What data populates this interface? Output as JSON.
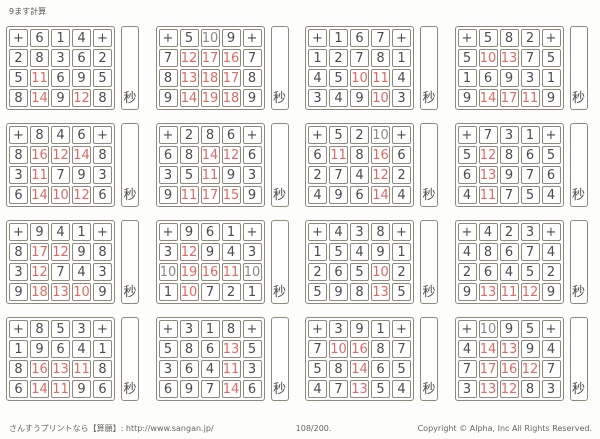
{
  "page": {
    "title": "9ます計算",
    "seconds_label": "秒",
    "footer": {
      "site": "さんすうプリントなら【算願】: http://www.sangan.jp/",
      "page_number": "108/200.",
      "copyright": "Copyright © Alpha, Inc All Rights Reserved."
    },
    "colors": {
      "border": "#8e897b",
      "digit": "#4c4c4c",
      "answer_red": "#cf3a35"
    }
  },
  "grids": [
    {
      "top": [
        "+",
        "6",
        "1",
        "4",
        "+"
      ],
      "rows": [
        {
          "left": "2",
          "answers": [
            "8",
            "3",
            "6"
          ],
          "right": "2"
        },
        {
          "left": "5",
          "answers": [
            "11",
            "6",
            "9"
          ],
          "right": "5"
        },
        {
          "left": "8",
          "answers": [
            "14",
            "9",
            "12"
          ],
          "right": "8"
        }
      ]
    },
    {
      "top": [
        "+",
        "5",
        "10",
        "9",
        "+"
      ],
      "rows": [
        {
          "left": "7",
          "answers": [
            "12",
            "17",
            "16"
          ],
          "right": "7"
        },
        {
          "left": "8",
          "answers": [
            "13",
            "18",
            "17"
          ],
          "right": "8"
        },
        {
          "left": "9",
          "answers": [
            "14",
            "19",
            "18"
          ],
          "right": "9"
        }
      ]
    },
    {
      "top": [
        "+",
        "1",
        "6",
        "7",
        "+"
      ],
      "rows": [
        {
          "left": "1",
          "answers": [
            "2",
            "7",
            "8"
          ],
          "right": "1"
        },
        {
          "left": "4",
          "answers": [
            "5",
            "10",
            "11"
          ],
          "right": "4"
        },
        {
          "left": "3",
          "answers": [
            "4",
            "9",
            "10"
          ],
          "right": "3"
        }
      ]
    },
    {
      "top": [
        "+",
        "5",
        "8",
        "2",
        "+"
      ],
      "rows": [
        {
          "left": "5",
          "answers": [
            "10",
            "13",
            "7"
          ],
          "right": "5"
        },
        {
          "left": "1",
          "answers": [
            "6",
            "9",
            "3"
          ],
          "right": "1"
        },
        {
          "left": "9",
          "answers": [
            "14",
            "17",
            "11"
          ],
          "right": "9"
        }
      ]
    },
    {
      "top": [
        "+",
        "8",
        "4",
        "6",
        "+"
      ],
      "rows": [
        {
          "left": "8",
          "answers": [
            "16",
            "12",
            "14"
          ],
          "right": "8"
        },
        {
          "left": "3",
          "answers": [
            "11",
            "7",
            "9"
          ],
          "right": "3"
        },
        {
          "left": "6",
          "answers": [
            "14",
            "10",
            "12"
          ],
          "right": "6"
        }
      ]
    },
    {
      "top": [
        "+",
        "2",
        "8",
        "6",
        "+"
      ],
      "rows": [
        {
          "left": "6",
          "answers": [
            "8",
            "14",
            "12"
          ],
          "right": "6"
        },
        {
          "left": "3",
          "answers": [
            "5",
            "11",
            "9"
          ],
          "right": "3"
        },
        {
          "left": "9",
          "answers": [
            "11",
            "17",
            "15"
          ],
          "right": "9"
        }
      ]
    },
    {
      "top": [
        "+",
        "5",
        "2",
        "10",
        "+"
      ],
      "rows": [
        {
          "left": "6",
          "answers": [
            "11",
            "8",
            "16"
          ],
          "right": "6"
        },
        {
          "left": "2",
          "answers": [
            "7",
            "4",
            "12"
          ],
          "right": "2"
        },
        {
          "left": "4",
          "answers": [
            "9",
            "6",
            "14"
          ],
          "right": "4"
        }
      ]
    },
    {
      "top": [
        "+",
        "7",
        "3",
        "1",
        "+"
      ],
      "rows": [
        {
          "left": "5",
          "answers": [
            "12",
            "8",
            "6"
          ],
          "right": "5"
        },
        {
          "left": "6",
          "answers": [
            "13",
            "9",
            "7"
          ],
          "right": "6"
        },
        {
          "left": "4",
          "answers": [
            "11",
            "7",
            "5"
          ],
          "right": "4"
        }
      ]
    },
    {
      "top": [
        "+",
        "9",
        "4",
        "1",
        "+"
      ],
      "rows": [
        {
          "left": "8",
          "answers": [
            "17",
            "12",
            "9"
          ],
          "right": "8"
        },
        {
          "left": "3",
          "answers": [
            "12",
            "7",
            "4"
          ],
          "right": "3"
        },
        {
          "left": "9",
          "answers": [
            "18",
            "13",
            "10"
          ],
          "right": "9"
        }
      ]
    },
    {
      "top": [
        "+",
        "9",
        "6",
        "1",
        "+"
      ],
      "rows": [
        {
          "left": "3",
          "answers": [
            "12",
            "9",
            "4"
          ],
          "right": "3"
        },
        {
          "left": "10",
          "answers": [
            "19",
            "16",
            "11"
          ],
          "right": "10"
        },
        {
          "left": "1",
          "answers": [
            "10",
            "7",
            "2"
          ],
          "right": "1"
        }
      ]
    },
    {
      "top": [
        "+",
        "4",
        "3",
        "8",
        "+"
      ],
      "rows": [
        {
          "left": "1",
          "answers": [
            "5",
            "4",
            "9"
          ],
          "right": "1"
        },
        {
          "left": "2",
          "answers": [
            "6",
            "5",
            "10"
          ],
          "right": "2"
        },
        {
          "left": "5",
          "answers": [
            "9",
            "8",
            "13"
          ],
          "right": "5"
        }
      ]
    },
    {
      "top": [
        "+",
        "4",
        "2",
        "3",
        "+"
      ],
      "rows": [
        {
          "left": "4",
          "answers": [
            "8",
            "6",
            "7"
          ],
          "right": "4"
        },
        {
          "left": "2",
          "answers": [
            "6",
            "4",
            "5"
          ],
          "right": "2"
        },
        {
          "left": "9",
          "answers": [
            "13",
            "11",
            "12"
          ],
          "right": "9"
        }
      ]
    },
    {
      "top": [
        "+",
        "8",
        "5",
        "3",
        "+"
      ],
      "rows": [
        {
          "left": "1",
          "answers": [
            "9",
            "6",
            "4"
          ],
          "right": "1"
        },
        {
          "left": "8",
          "answers": [
            "16",
            "13",
            "11"
          ],
          "right": "8"
        },
        {
          "left": "6",
          "answers": [
            "14",
            "11",
            "9"
          ],
          "right": "6"
        }
      ]
    },
    {
      "top": [
        "+",
        "3",
        "1",
        "8",
        "+"
      ],
      "rows": [
        {
          "left": "5",
          "answers": [
            "8",
            "6",
            "13"
          ],
          "right": "5"
        },
        {
          "left": "3",
          "answers": [
            "6",
            "4",
            "11"
          ],
          "right": "3"
        },
        {
          "left": "6",
          "answers": [
            "9",
            "7",
            "14"
          ],
          "right": "6"
        }
      ]
    },
    {
      "top": [
        "+",
        "3",
        "9",
        "1",
        "+"
      ],
      "rows": [
        {
          "left": "7",
          "answers": [
            "10",
            "16",
            "8"
          ],
          "right": "7"
        },
        {
          "left": "5",
          "answers": [
            "8",
            "14",
            "6"
          ],
          "right": "5"
        },
        {
          "left": "4",
          "answers": [
            "7",
            "13",
            "5"
          ],
          "right": "4"
        }
      ]
    },
    {
      "top": [
        "+",
        "10",
        "9",
        "5",
        "+"
      ],
      "rows": [
        {
          "left": "4",
          "answers": [
            "14",
            "13",
            "9"
          ],
          "right": "4"
        },
        {
          "left": "7",
          "answers": [
            "17",
            "16",
            "12"
          ],
          "right": "7"
        },
        {
          "left": "3",
          "answers": [
            "13",
            "12",
            "8"
          ],
          "right": "3"
        }
      ]
    }
  ]
}
